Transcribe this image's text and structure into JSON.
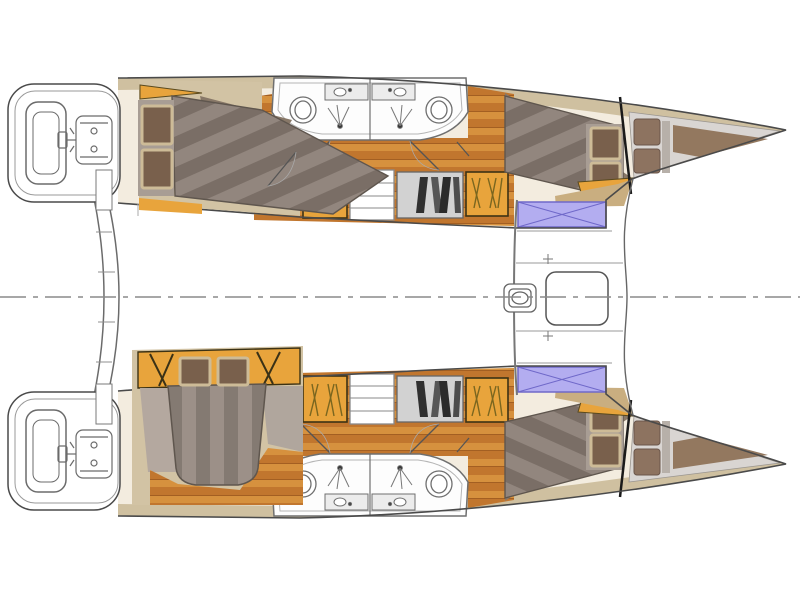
{
  "diagram": {
    "type": "boat-floor-plan",
    "subject": "Catamaran interior layout plan, top-down view, bows pointing right",
    "regions": [
      {
        "name": "centerline",
        "desc": "dash-dot longitudinal centerline of the boat"
      },
      {
        "name": "aft-crossbeam",
        "desc": "curved aft crossbeam with boarding steps between the two transoms"
      },
      {
        "name": "hull-top",
        "desc": "port hull with aft double cabin, bathroom, companionway, forward cabin and forepeak"
      },
      {
        "name": "hull-bottom",
        "desc": "starboard hull with owner island-bed cabin, bathroom, companionway, forward cabin and forepeak"
      },
      {
        "name": "stern-platform",
        "desc": "rounded transom swim platform with seat and engine/tender outline"
      },
      {
        "name": "engine-sketch",
        "desc": "schematic outline of engine / steering gear on the transom"
      },
      {
        "name": "cabin-aft-top",
        "desc": "aft guest cabin with double berth and two pillows"
      },
      {
        "name": "cabin-owner-bottom",
        "desc": "owner cabin with island double berth, headboard and side tables"
      },
      {
        "name": "bathroom-block",
        "desc": "twin back-to-back bathrooms with toilet, sink counter and shower with drain"
      },
      {
        "name": "companionway",
        "desc": "stairs flanked by orange lockers and a grey shelf with books"
      },
      {
        "name": "cabin-forward",
        "desc": "forward double berth with striped duvet and two pillows"
      },
      {
        "name": "forepeak",
        "desc": "bow storage / skipper berth area beyond the black collision bulkhead"
      },
      {
        "name": "deck-hatch",
        "desc": "lavender deck hatch with X cross bracing"
      },
      {
        "name": "foredeck",
        "desc": "central foredeck between hulls with windlass and anchor locker"
      },
      {
        "name": "windlass",
        "desc": "anchor windlass fitting on centerline"
      },
      {
        "name": "anchor-locker",
        "desc": "rounded anchor locker lid on the foredeck"
      }
    ],
    "palette": {
      "outline": "#4a4a4a",
      "hullBase": "#f3ecdf",
      "khaki": "#cfc0a0",
      "cabinBg": "#d2c3a4",
      "taupe": "#887868",
      "wood": "#c1762e",
      "woodLight": "#d6913e",
      "woodLine": "#a35f22",
      "orange": "#e8a43c",
      "orangeDark": "#5a4a1e",
      "bedLight": "#92867e",
      "bedDark": "#7a6e66",
      "pillow": "#79604c",
      "pillowBorder": "#cdbb97",
      "panel": "#a89d94",
      "bathroom": "#fdfdfd",
      "fixture": "#6f6f6f",
      "shelf": "#d2d2d2",
      "books": "#303030",
      "purple": "#b3adf0",
      "purpleBorder": "#6f68c9",
      "forepeak": "#d9d5d2",
      "forepeakCushion": "#8d7360",
      "forepeakWedge": "#93785f",
      "centerline": "#8a8a8a",
      "white": "#ffffff"
    }
  }
}
